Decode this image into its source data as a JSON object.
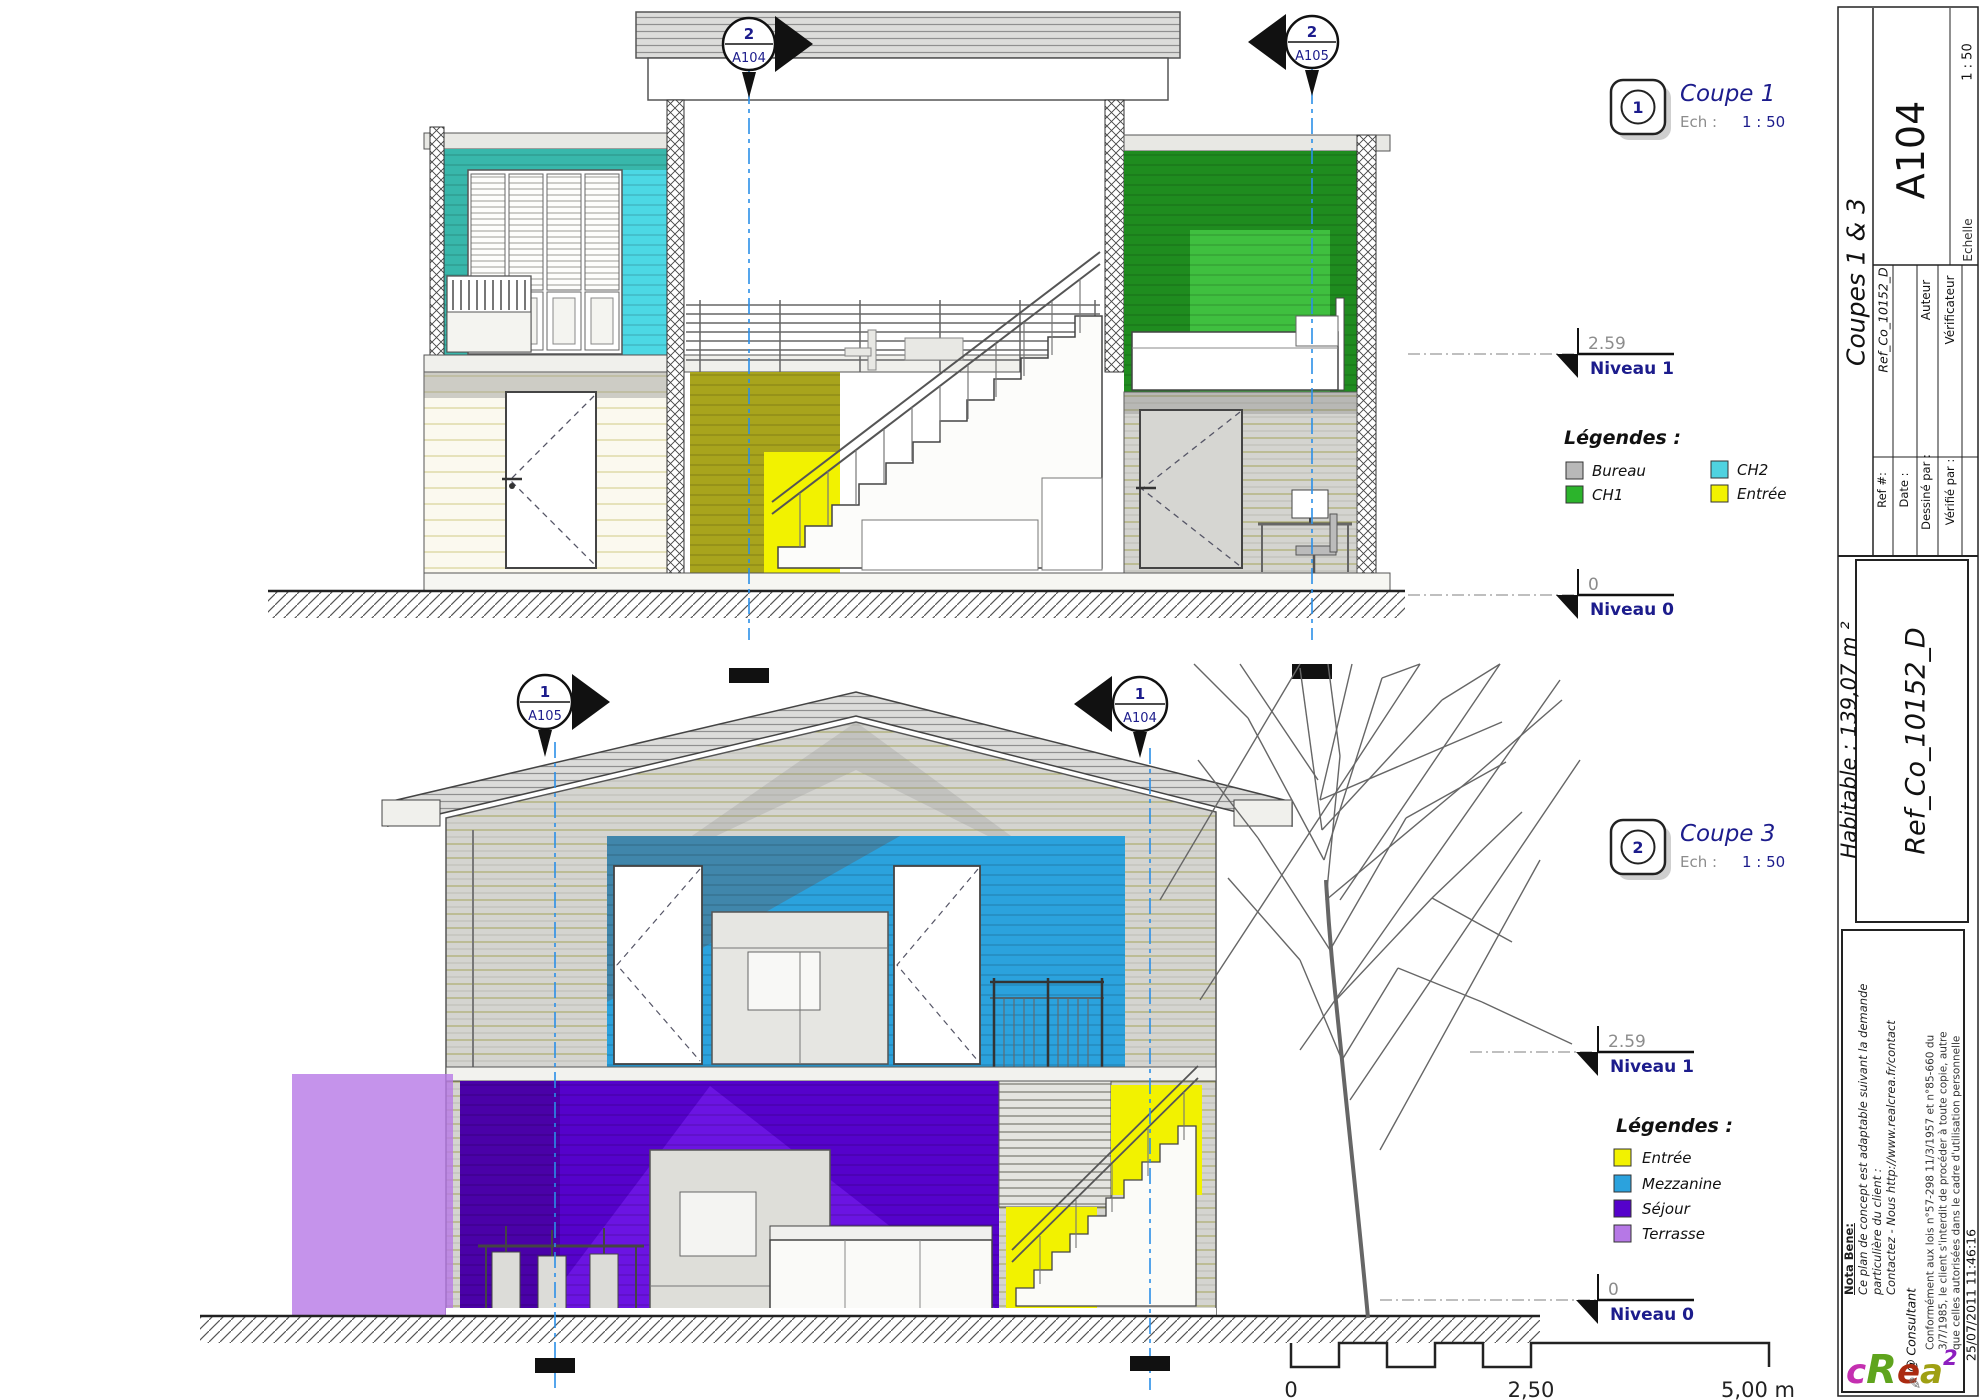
{
  "sheet": {
    "number": "A104",
    "title": "Coupes 1 & 3",
    "habitable": "Habitable : 139,07 m ²",
    "reference_big": "Ref_Co_10152_D",
    "fields": {
      "ref_label": "Ref #:",
      "ref_value": "Ref_Co_10152_D",
      "date_label": "Date :",
      "drawn_label": "Dessiné par :",
      "drawn_value": "Auteur",
      "checked_label": "Vérifié par :",
      "checked_value": "Vérificateur",
      "scale_label": "Echelle",
      "scale_value": "1 : 50"
    }
  },
  "views": {
    "coupe1": {
      "badge": "1",
      "name": "Coupe 1",
      "ech_label": "Ech :",
      "scale": "1 : 50"
    },
    "coupe3": {
      "badge": "2",
      "name": "Coupe 3",
      "ech_label": "Ech :",
      "scale": "1 : 50"
    }
  },
  "section_markers": {
    "top_center": {
      "num": "2",
      "sheet": "A104"
    },
    "top_right": {
      "num": "2",
      "sheet": "A105"
    },
    "bottom_left": {
      "num": "1",
      "sheet": "A105"
    },
    "bottom_right": {
      "num": "1",
      "sheet": "A104"
    }
  },
  "levels": {
    "n1_elev": "2.59",
    "n1_name": "Niveau 1",
    "n0_elev": "0",
    "n0_name": "Niveau 0"
  },
  "legends": [
    {
      "title": "Légendes :",
      "items": [
        {
          "label": "Bureau",
          "color": "#b8b8b8"
        },
        {
          "label": "CH1",
          "color": "#2cb42c"
        },
        {
          "label": "CH2",
          "color": "#4fd2e0"
        },
        {
          "label": "Entrée",
          "color": "#f2f200"
        }
      ]
    },
    {
      "title": "Légendes :",
      "items": [
        {
          "label": "Entrée",
          "color": "#f2f200"
        },
        {
          "label": "Mezzanine",
          "color": "#2ba2dd"
        },
        {
          "label": "Séjour",
          "color": "#5502cb"
        },
        {
          "label": "Terrasse",
          "color": "#b678e6"
        }
      ]
    }
  ],
  "scale_bar": {
    "zero": "0",
    "mid": "2,50",
    "end": "5,00 m"
  },
  "notes": {
    "nota_title": "Nota Bene:",
    "nota_line1": "Ce plan de concept est adaptable suivant la demande",
    "nota_line2": "particulière du client :",
    "nota_line3": "Contactez - Nous http://www.realcrea.fr/contact",
    "conf_line1": "Conformément aux lois n°57-298 11/3/1957 et n°85-660 du",
    "conf_line2": "3/7/1985, le client s'interdit de procéder à toute copie, autre",
    "conf_line3": "que celles autorisées dans le cadre d'utilisation personnelle",
    "consultant": "@ Consultant",
    "timestamp": "25/07/2011 11:46:16"
  },
  "logo": {
    "l1": "c",
    "l2": "R",
    "l3": "e",
    "l4": "a",
    "sup": "2",
    "l5": "l",
    "c1": "#c42fb0",
    "c2": "#5fa41d",
    "c3": "#ab2a10",
    "c4": "#9fa013",
    "c5": "#8d1fbf",
    "c6": "#25b2b8"
  },
  "rooms": {
    "teal": "#38b7ab",
    "teal_light": "#4cd8e4",
    "green": "#1f8c1f",
    "green_light": "#3fbf3f",
    "olive": "#a8a41c",
    "yellow": "#f2f200",
    "blue": "#2ba2dd",
    "purple": "#5502cb",
    "purple_dark": "#4a01a8",
    "purple_light": "#6b14e2",
    "terrasse": "#b678e6"
  }
}
